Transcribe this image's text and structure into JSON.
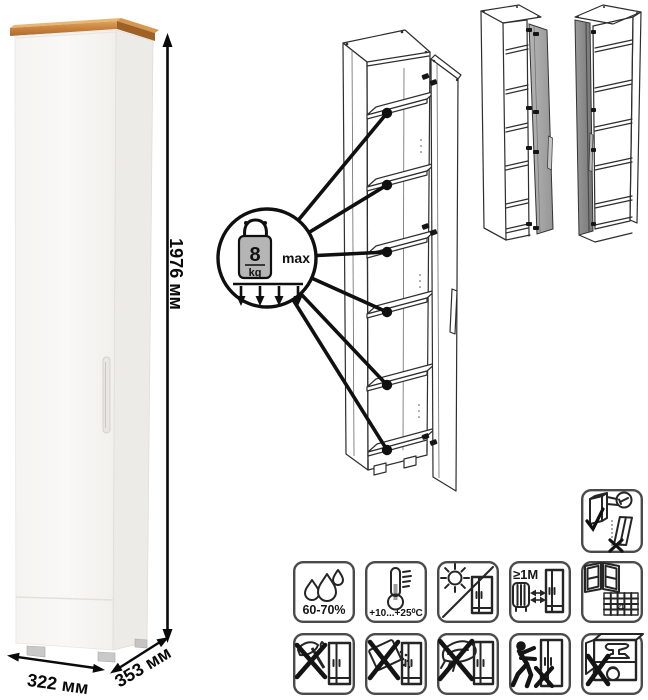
{
  "product_sheet": {
    "dimension_labels": {
      "height": "1976 мм",
      "width": "322 мм",
      "depth": "353 мм"
    },
    "shelf_load": {
      "value": "8",
      "unit": "kg",
      "qualifier": "max",
      "pointed_shelves": 6
    },
    "care_labels": {
      "humidity_range": "60-70%",
      "temperature_range": "+10...+25⁰C",
      "heater_min_distance": "≥1М",
      "calendar_day": "21"
    },
    "icon_names": [
      "load-weight-icon",
      "humidity-icon",
      "temperature-icon",
      "no-direct-sunlight-icon",
      "heater-distance-icon",
      "ventilation-icon",
      "no-sharp-tools-icon",
      "no-chemical-spill-icon",
      "no-wet-abrasive-cleaning-icon",
      "no-pushing-icon",
      "no-heavy-items-icon",
      "anchor-to-wall-icon"
    ],
    "colors": {
      "background": "#ffffff",
      "wood_top": "#c9823d",
      "cabinet_front": "#f7f6f3",
      "cabinet_side": "#edebe7",
      "feet": "#c9c9c9",
      "outline": "#2e2e2e",
      "door_variant_gray": "#a9a9a9",
      "door_variant_dark": "#8a8a8a",
      "weight_gray": "#b5b5b5"
    }
  }
}
